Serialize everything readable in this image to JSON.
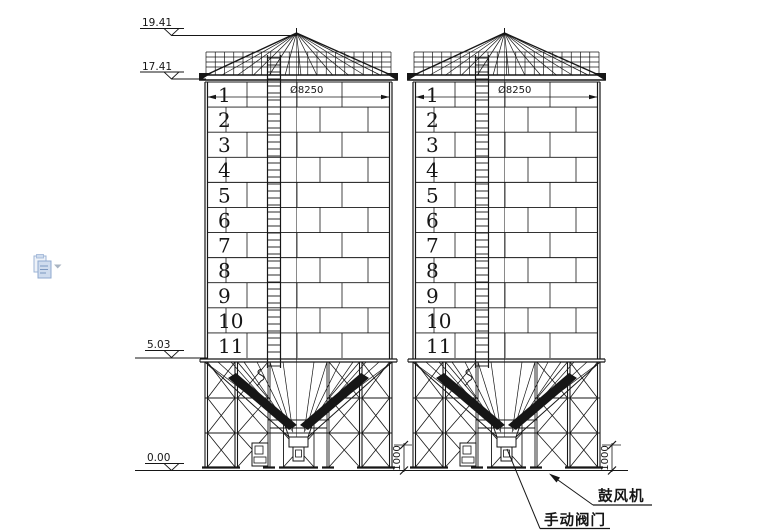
{
  "elevations": {
    "roof_apex": "19.41",
    "eave": "17.41",
    "hopper_top": "5.03",
    "ground": "0.00"
  },
  "silo": {
    "diameter_label": "Ø8250",
    "rings": [
      "1",
      "2",
      "3",
      "4",
      "5",
      "6",
      "7",
      "8",
      "9",
      "10",
      "11"
    ]
  },
  "dims": {
    "outlet_height": "1000"
  },
  "labels": {
    "blower": "鼓风机",
    "manual_valve": "手动阀门"
  },
  "icons": {
    "paste_options": "paste-options"
  },
  "colors": {
    "line": "#161616",
    "background": "#ffffff",
    "icon_fill": "#cfdcee",
    "icon_stroke": "#8fa9cf"
  }
}
